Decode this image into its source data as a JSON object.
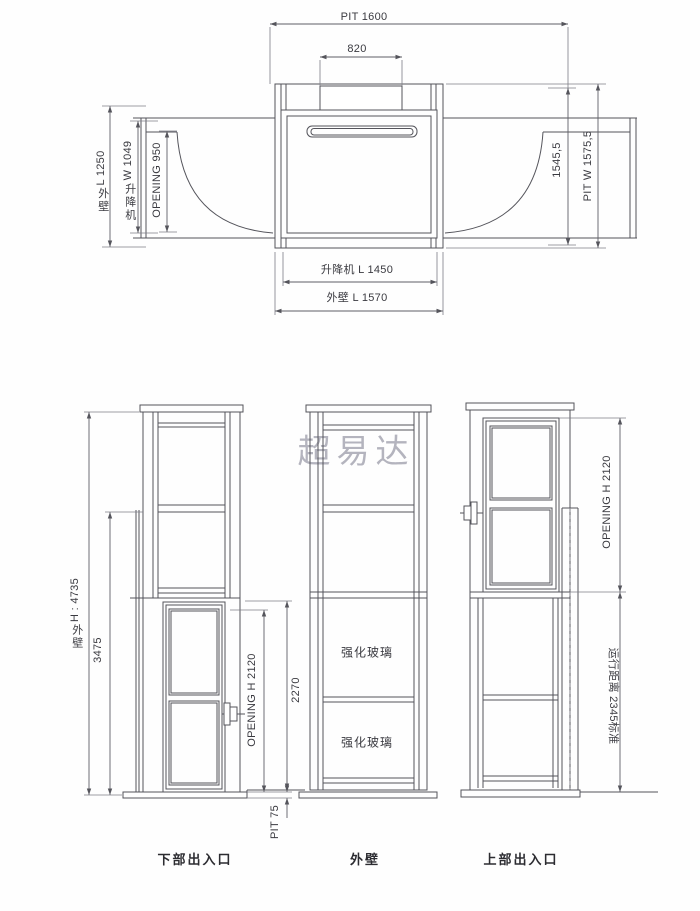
{
  "watermark": "超易达",
  "plan_view": {
    "pit_width": "PIT 1600",
    "machine_opening": "820",
    "outer_wall_left": {
      "cjk": "外壁",
      "val": "L 1250"
    },
    "lift_width_left": {
      "cjk": "升降机",
      "val": "W 1049"
    },
    "opening_left": "OPENING 950",
    "inner_depth_right": "1545,5",
    "pit_depth_right": "PIT W 1575,5",
    "lift_length_bottom": "升降机 L 1450",
    "outer_wall_bottom": "外壁 L 1570"
  },
  "elevation_views": {
    "overall_height": {
      "cjk": "外壁",
      "val": "H : 4735"
    },
    "upper_landing_height": "3475",
    "lower_opening_height": "OPENING H 2120",
    "lower_door_height": "2270",
    "pit_depth": "PIT 75",
    "glass_panel_1": "强化玻璃",
    "glass_panel_2": "强化玻璃",
    "upper_opening_height": "OPENING H 2120",
    "travel_distance": "运行距离 2345标准",
    "captions": {
      "lower_entrance": "下部出入口",
      "outer_wall": "外壁",
      "upper_entrance": "上部出入口"
    }
  }
}
